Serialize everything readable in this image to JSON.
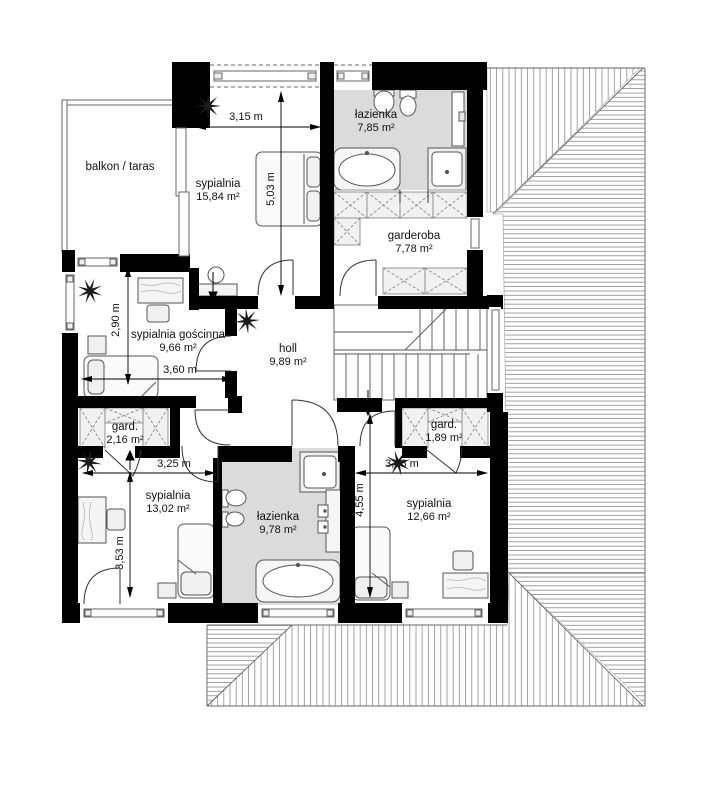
{
  "plan": {
    "floor_name": "floor-plan-upper-storey",
    "rooms": [
      {
        "id": "balkon",
        "name": "balkon / taras",
        "area": ""
      },
      {
        "id": "sypialnia-1",
        "name": "sypialnia",
        "area": "15,84 m²"
      },
      {
        "id": "lazienka-1",
        "name": "łazienka",
        "area": "7,85 m²"
      },
      {
        "id": "garderoba",
        "name": "garderoba",
        "area": "7,78 m²"
      },
      {
        "id": "sypialnia-goscinna",
        "name": "sypialnia gościnna",
        "area": "9,66 m²"
      },
      {
        "id": "holl",
        "name": "holl",
        "area": "9,89 m²"
      },
      {
        "id": "gard-1",
        "name": "gard.",
        "area": "2,16 m²"
      },
      {
        "id": "gard-2",
        "name": "gard.",
        "area": "1,89 m²"
      },
      {
        "id": "sypialnia-2",
        "name": "sypialnia",
        "area": "13,02 m²"
      },
      {
        "id": "lazienka-2",
        "name": "łazienka",
        "area": "9,78 m²"
      },
      {
        "id": "sypialnia-3",
        "name": "sypialnia",
        "area": "12,66 m²"
      }
    ],
    "dimensions": [
      {
        "id": "dim-top-width",
        "label": "3,15 m",
        "orientation": "horizontal"
      },
      {
        "id": "dim-bed1-depth",
        "label": "5,03 m",
        "orientation": "vertical"
      },
      {
        "id": "dim-guest-depth",
        "label": "2,90 m",
        "orientation": "vertical"
      },
      {
        "id": "dim-guest-width",
        "label": "3,60 m",
        "orientation": "horizontal"
      },
      {
        "id": "dim-bed2-width",
        "label": "3,25 m",
        "orientation": "horizontal"
      },
      {
        "id": "dim-bed3-width",
        "label": "3,28 m",
        "orientation": "horizontal"
      },
      {
        "id": "dim-bed3-depth",
        "label": "4,55 m",
        "orientation": "vertical"
      },
      {
        "id": "dim-bed2-depth",
        "label": "3,53 m",
        "orientation": "vertical"
      }
    ],
    "colors": {
      "wall": "#000000",
      "bath_floor": "#dbdbdb",
      "roof_hatch": "#8a8a8a",
      "line": "#444444"
    }
  }
}
